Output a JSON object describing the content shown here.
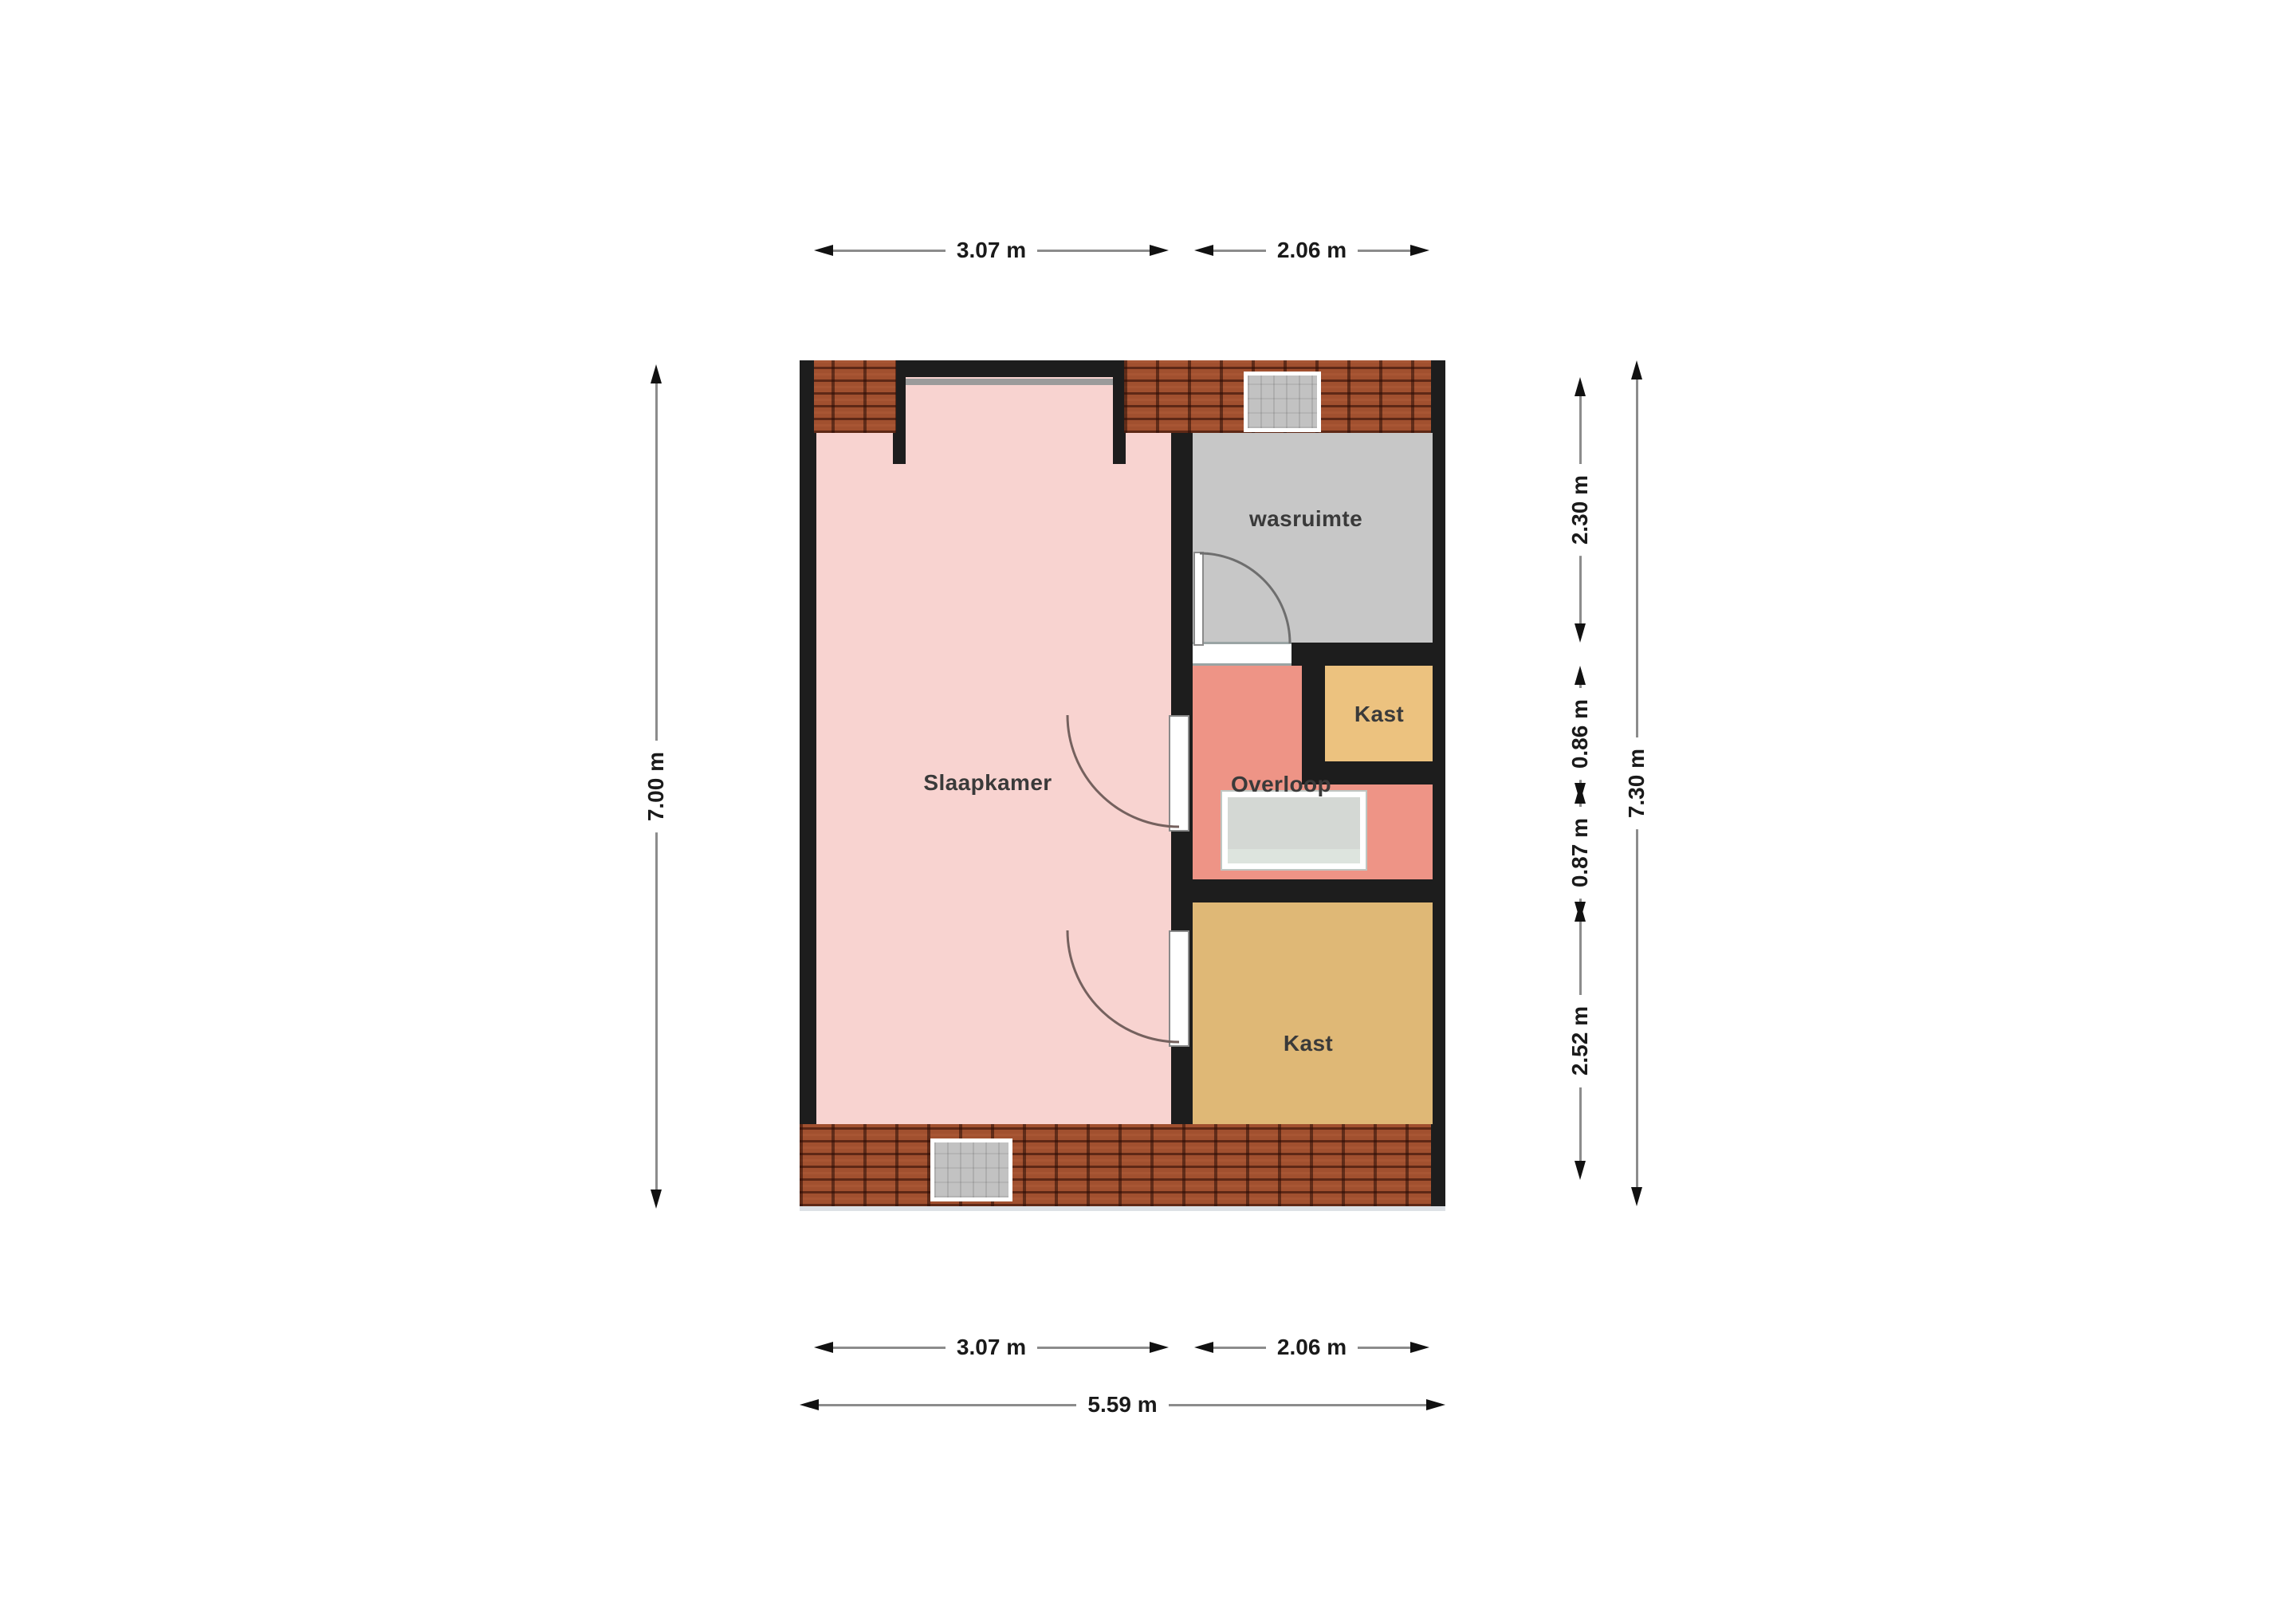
{
  "plan": {
    "type": "floorplan",
    "rooms": {
      "slaapkamer": {
        "label": "Slaapkamer",
        "color": "#f8d3d0"
      },
      "wasruimte": {
        "label": "wasruimte",
        "color": "#c7c7c7"
      },
      "kast_boven": {
        "label": "Kast",
        "color": "#ecc27f"
      },
      "overloop": {
        "label": "Overloop",
        "color": "#ee9486"
      },
      "kast_onder": {
        "label": "Kast",
        "color": "#dfb876"
      }
    },
    "wall_color": "#1d1d1d",
    "roof_tile_color": "#a1502f",
    "stair_opening_color": "#d4d8d4"
  },
  "dims": {
    "top": [
      "3.07 m",
      "2.06 m"
    ],
    "bottom": [
      "3.07 m",
      "2.06 m"
    ],
    "bottom_total": "5.59 m",
    "left_total": "7.00 m",
    "right": [
      "2.30 m",
      "0.86 m",
      "0.87 m",
      "2.52 m"
    ],
    "right_total": "7.30 m"
  }
}
